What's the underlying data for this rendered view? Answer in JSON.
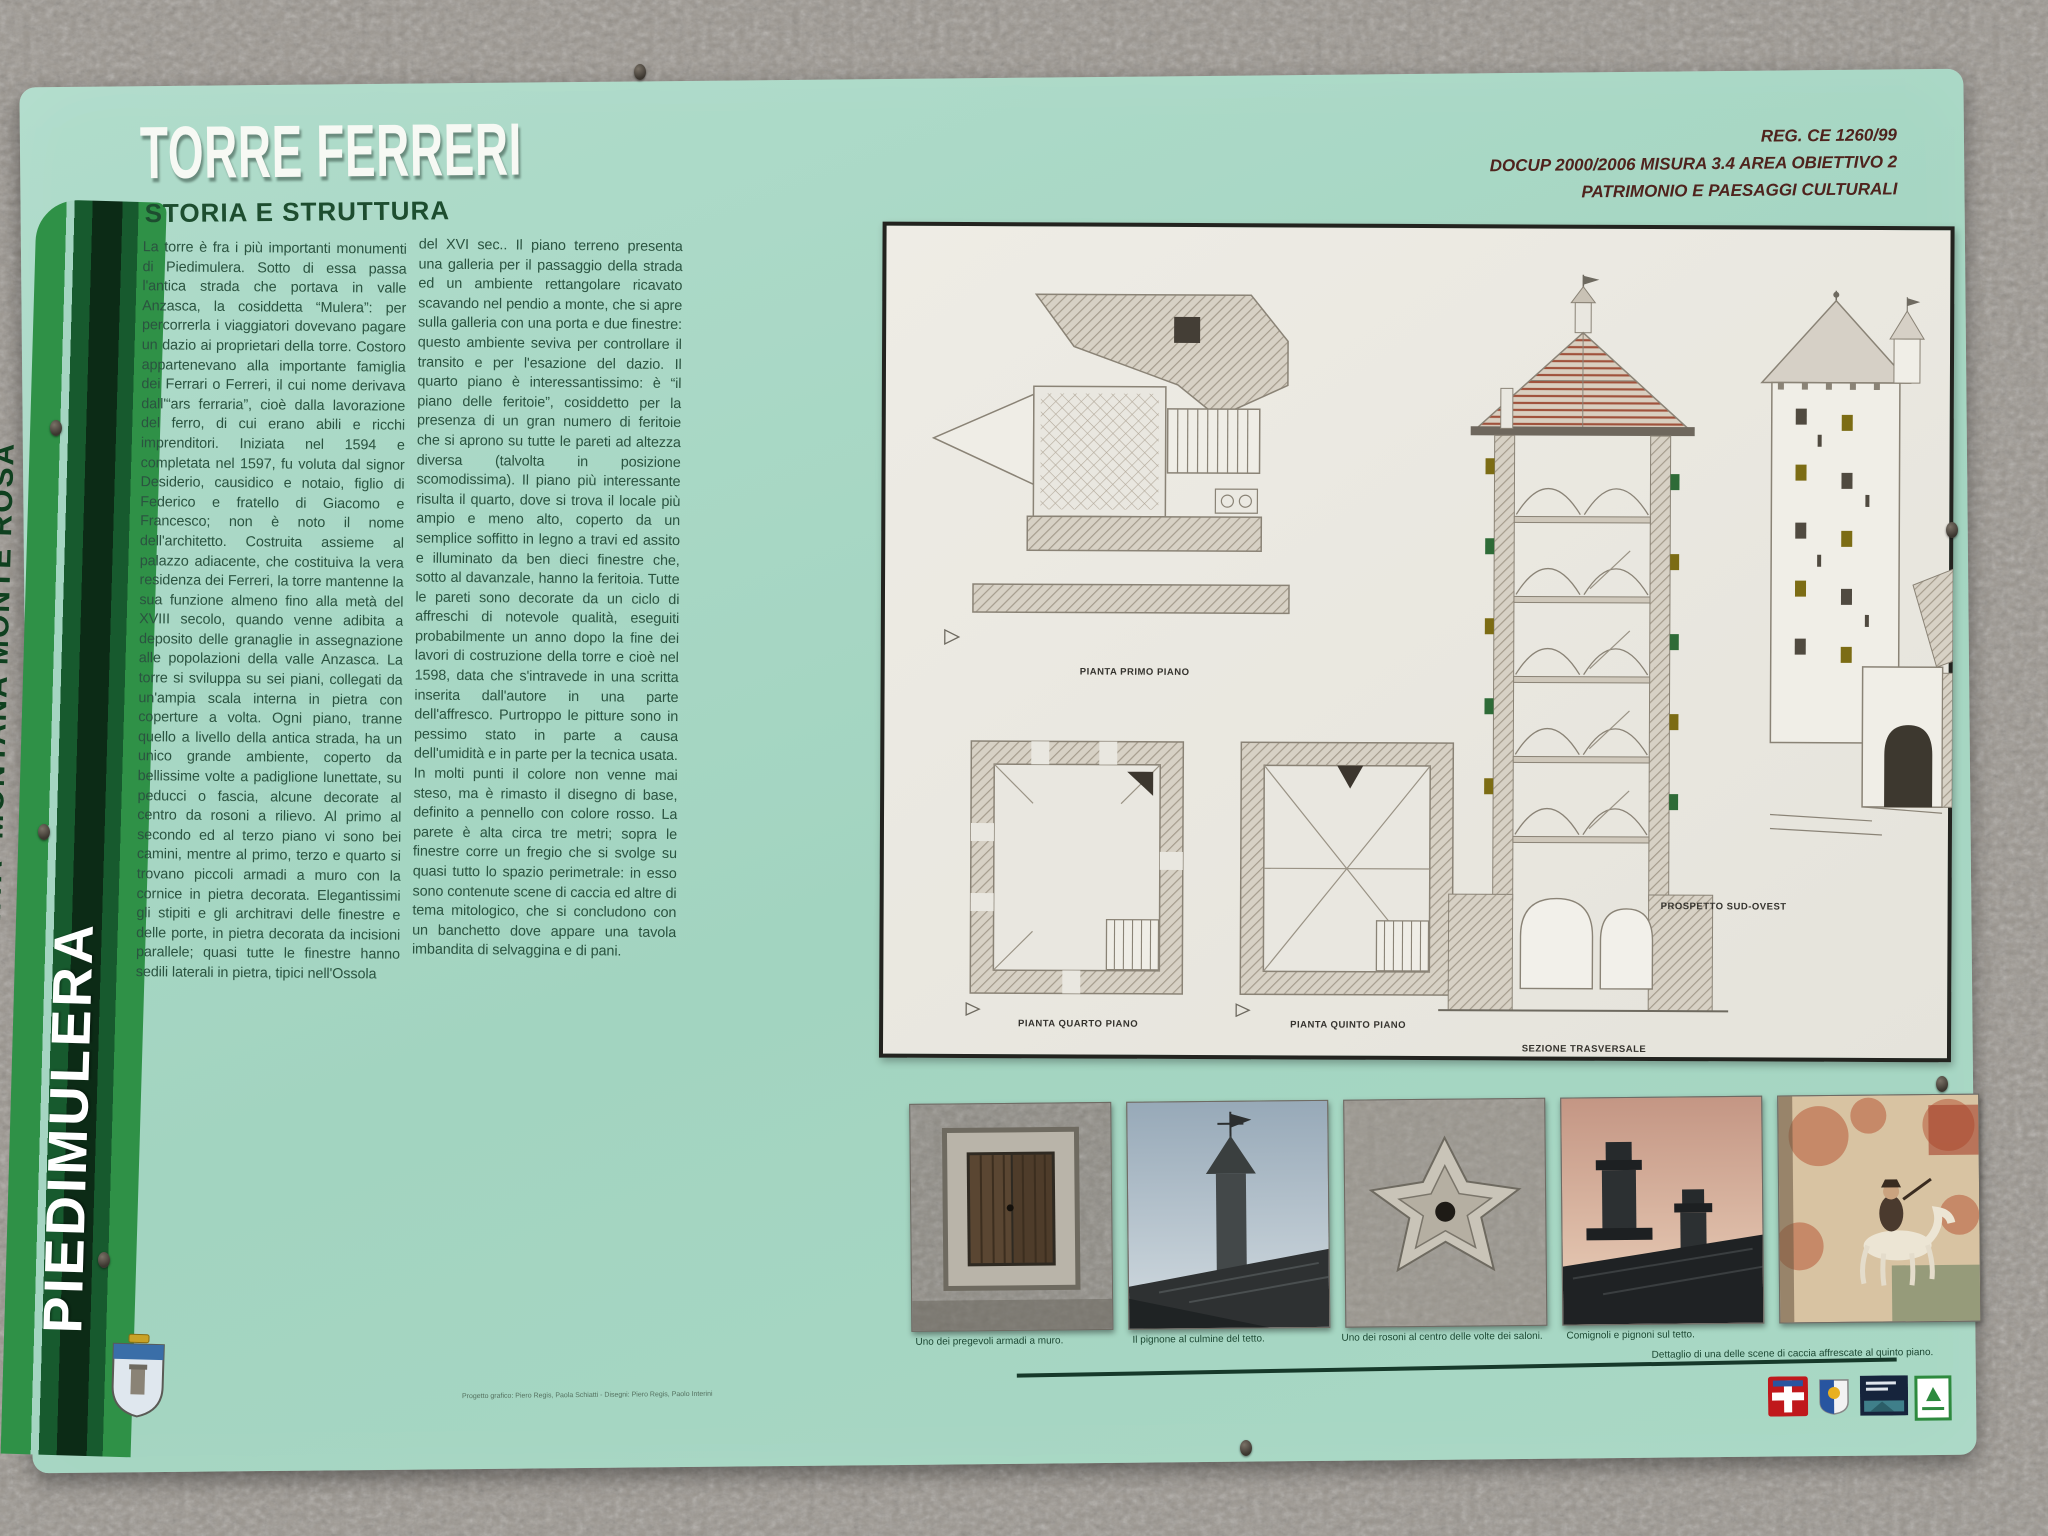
{
  "panel": {
    "title": "TORRE FERRERI",
    "subtitle": "STORIA E STRUTTURA",
    "header_right": {
      "line1": "REG. CE 1260/99",
      "line2": "DOCUP 2000/2006 MISURA 3.4 AREA OBIETTIVO 2",
      "line3": "PATRIMONIO E PAESAGGI CULTURALI"
    },
    "sidebar": {
      "community": "COMUNITA' MONTANA MONTE ROSA",
      "town": "PIEDIMULERA"
    },
    "body": {
      "column1": "La torre è fra i più importanti monumenti di Piedimulera. Sotto di essa passa l'antica strada che portava in valle Anzasca, la cosiddetta “Mulera”: per percorrerla i viaggiatori dovevano pagare un dazio ai proprietari della torre. Costoro appartenevano alla importante famiglia dei Ferrari o Ferreri, il cui nome derivava dall'“ars ferraria”, cioè dalla lavorazione del ferro, di cui erano abili e ricchi imprenditori. Iniziata nel 1594 e completata nel 1597, fu voluta dal signor Desiderio, causidico e notaio, figlio di Federico e fratello di Giacomo e Francesco; non è noto il nome dell'architetto. Costruita assieme al palazzo adiacente, che costituiva la vera residenza dei Ferreri, la torre mantenne la sua funzione almeno fino alla metà del XVIII secolo, quando venne adibita a deposito delle granaglie in assegnazione alle popolazioni della valle Anzasca. La torre si sviluppa su sei piani, collegati da un'ampia scala interna in pietra con coperture a volta. Ogni piano, tranne quello a livello della antica strada, ha un unico grande ambiente, coperto da bellissime volte a padiglione lunettate, su peducci o fascia, alcune decorate al centro da rosoni a rilievo. Al primo al secondo ed al terzo piano vi sono bei camini, mentre al primo, terzo e quarto si trovano piccoli armadi a muro con la cornice in pietra decorata. Elegantissimi gli stipiti e gli architravi delle finestre e delle porte, in pietra decorata da incisioni parallele; quasi tutte le finestre hanno sedili laterali in pietra, tipici nell'Ossola",
      "column2": "del XVI sec.. Il piano terreno presenta una galleria per il passaggio della strada ed un ambiente rettangolare ricavato scavando nel pendio a monte, che si apre sulla galleria con una porta e due finestre: questo ambiente seviva per controllare il transito e per l'esazione del dazio. Il quarto piano è interessantissimo: è “il piano delle feritoie”, cosiddetto per la presenza di un gran numero di feritoie che si aprono su tutte le pareti ad altezza diversa (talvolta in posizione scomodissima). Il piano più interessante risulta il quarto, dove si trova il locale più ampio e meno alto, coperto da un semplice soffitto in legno a travi ed assito e illuminato da ben dieci finestre che, sotto al davanzale, hanno la feritoia. Tutte le pareti sono decorate da un ciclo di affreschi di notevole qualità, eseguiti probabilmente un anno dopo la fine dei lavori di costruzione della torre e cioè nel 1598, data che s'intravede in una scritta inserita dall'autore in una parte dell'affresco. Purtroppo le pitture sono in pessimo stato in parte a causa dell'umidità e in parte per la tecnica usata. In molti punti il colore non venne mai steso, ma è rimasto il disegno di base, definito a pennello con colore rosso. La parete è alta circa tre metri; sopra le finestre corre un fregio che si svolge su quasi tutto lo spazio perimetrale: in esso sono contenute scene di caccia ed altre di tema mitologico, che si concludono con un banchetto dove appare una tavola imbandita di selvaggina e di pani."
    },
    "drawings": {
      "label_primo": "PIANTA PRIMO PIANO",
      "label_quarto": "PIANTA QUARTO PIANO",
      "label_quinto": "PIANTA QUINTO PIANO",
      "label_sezione": "SEZIONE TRASVERSALE",
      "label_prospetto": "PROSPETTO SUD-OVEST"
    },
    "photos": [
      {
        "caption": "Uno dei pregevoli armadi a muro."
      },
      {
        "caption": "Il pignone al culmine del tetto."
      },
      {
        "caption": "Uno dei rosoni al centro delle volte dei saloni."
      },
      {
        "caption": "Comignoli e pignoni sul tetto."
      },
      {
        "caption": "Dettaglio di una delle scene di caccia affrescate al quinto piano."
      }
    ],
    "credits": "Progetto grafico: Piero Regis, Paola Schiatti  -  Disegni: Piero Regis, Paolo Interini",
    "colors": {
      "panel_green": "#a5d5c2",
      "stripe_bright_green": "#2f9147",
      "stripe_dark_green": "#175a2e",
      "stripe_deep_green": "#0c2b16",
      "text_green": "#2b5340",
      "title_white": "#f7f9f4",
      "header_maroon": "#4f231d",
      "drawing_paper": "#e9e7e0"
    }
  }
}
